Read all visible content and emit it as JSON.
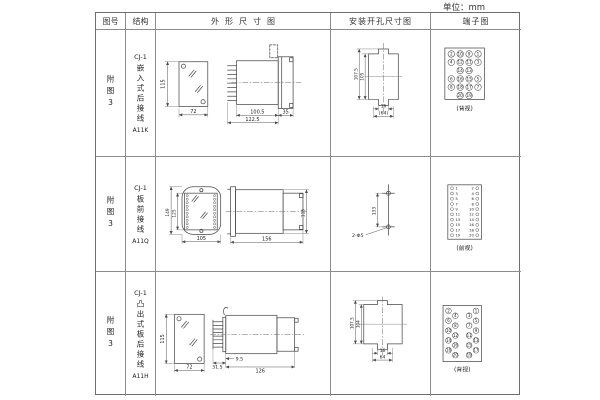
{
  "unit": "单位：mm",
  "header": {
    "cols": [
      "图号",
      "结构",
      "外形尺寸图",
      "安装开孔尺寸图",
      "端子图"
    ]
  },
  "rows": [
    {
      "fig": "附图3",
      "model": "CJ-1",
      "struct": "嵌入式后接线",
      "code": "A11K",
      "dims": {
        "front_h": "115",
        "front_w": "72",
        "side_a": "100.5",
        "side_b": "122.5",
        "side_c": "35"
      },
      "install": {
        "v1": "107.5",
        "v2": "105",
        "h1": "16",
        "h2": "(64)"
      },
      "terminals": [
        [
          "2",
          "10",
          "9",
          "1"
        ],
        [
          "4",
          "12",
          "11",
          "3"
        ],
        [
          "14",
          "13"
        ],
        [
          "6",
          "16",
          "15",
          "5"
        ],
        [
          "8",
          "18",
          "17",
          "7"
        ],
        [
          "20",
          "19"
        ]
      ],
      "view_label": "(背视)"
    },
    {
      "fig": "附图3",
      "model": "CJ-1",
      "struct": "板前接线",
      "code": "A11Q",
      "dims": {
        "front_h": "149",
        "front_h2": "125",
        "front_w": "105",
        "side_len": "156",
        "side_h": "115"
      },
      "install": {
        "v1": "133",
        "hole": "2-Φ5"
      },
      "terminals": {
        "left": [
          "1",
          "3",
          "5",
          "7",
          "9",
          "11",
          "13",
          "15",
          "17",
          "19"
        ],
        "right": [
          "2",
          "4",
          "6",
          "8",
          "10",
          "12",
          "14",
          "16",
          "18",
          "20"
        ]
      },
      "view_label": "(前视)"
    },
    {
      "fig": "附图3",
      "model": "CJ-1",
      "struct": "凸出式板后接线",
      "code": "A11H",
      "dims": {
        "front_h": "115",
        "front_w": "72",
        "side_a": "31.5",
        "side_b": "9.5",
        "side_c": "126"
      },
      "install": {
        "v1": "107.5",
        "v2": "104",
        "h1": "16",
        "h2": "64"
      },
      "terminals": {
        "lo": [
          "2",
          "6",
          "10",
          "14",
          "18"
        ],
        "li": [
          "4",
          "8",
          "12",
          "16",
          "20"
        ],
        "ri": [
          "3",
          "7",
          "11",
          "15",
          "19"
        ],
        "ro": [
          "1",
          "5",
          "9",
          "13",
          "17"
        ]
      },
      "view_label": "(背视)"
    }
  ]
}
